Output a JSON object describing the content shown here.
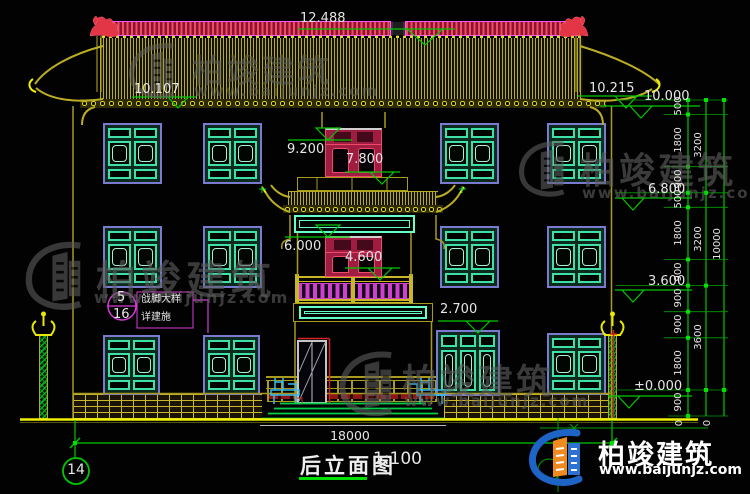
{
  "title_block": {
    "title": "后立面图",
    "scale": "1:100",
    "axis_bubble": "14"
  },
  "overall_dim": "18000",
  "levels": {
    "ridge": "12.488",
    "eave_left": "10.107",
    "eave_right": "10.215",
    "right_top": "10.000",
    "attic_top": "9.200",
    "attic_sill": "7.800",
    "right_upper": "6.800",
    "second_top": "6.000",
    "second_sill": "4.600",
    "right_mid": "3.600",
    "ground_window": "2.700",
    "zero": "±0.000"
  },
  "dim_chain": {
    "col1": [
      "500",
      "1800",
      "900",
      "500",
      "1800",
      "900",
      "900",
      "900",
      "1800",
      "900"
    ],
    "col2": [
      "3200",
      "3200",
      "3600"
    ],
    "col3": [
      "10000"
    ],
    "base": [
      "0",
      "0"
    ]
  },
  "callout": {
    "number": "5",
    "sheet": "16",
    "text_line1": "戗脚大样",
    "text_line2": "详建施"
  },
  "watermark": {
    "name": "柏竣建筑",
    "url": "www.baijunjz.com"
  },
  "logo": {
    "name": "柏竣建筑",
    "url": "www.baijunjz.com"
  },
  "colors": {
    "dim_green": "#00c800",
    "magenta": "#d83cd8",
    "crimson": "#a01d42",
    "teal": "#3fe0a8",
    "violet": "#7a7ad0",
    "olive": "#a89a1e",
    "yellow": "#f0f000",
    "baluster": "#cf3fd0",
    "cyan_band": "#66ffc8",
    "red": "#d22525",
    "logo_blue": "#1e63c6",
    "logo_orange": "#f08a20",
    "watermark_gray": "#5e5e5e"
  }
}
